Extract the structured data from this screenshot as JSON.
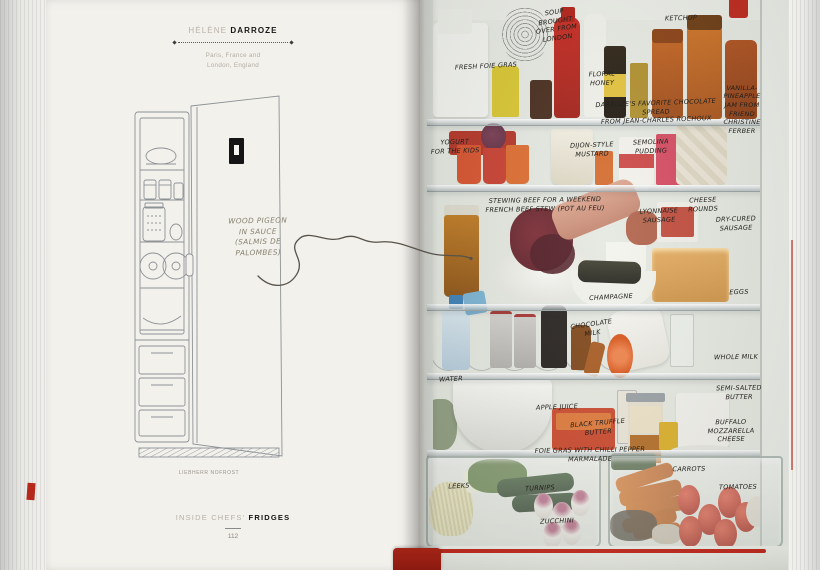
{
  "book": {
    "left_page": {
      "chef": {
        "first_name": "HÉLÈNE",
        "last_name": "DARROZE",
        "location_line1": "Paris, France and",
        "location_line2": "London, England"
      },
      "annotation": "WOOD PIGEON\nIN SAUCE\n(SALMIS DE\nPALOMBES)",
      "drawing_caption": "LIEBHERR NOFROST",
      "footer": {
        "series": "INSIDE CHEFS'",
        "title": "FRIDGES",
        "page_number": "112"
      }
    },
    "right_page": {
      "labels": [
        {
          "id": "soup",
          "text": "SOUP\nBROUGHT\nOVER FROM\nLONDON"
        },
        {
          "id": "ketchup",
          "text": "KETCHUP"
        },
        {
          "id": "fresh-foie-gras",
          "text": "FRESH FOIE GRAS"
        },
        {
          "id": "floral-honey",
          "text": "FLORAL\nHONEY"
        },
        {
          "id": "vanilla-pineapple-jam",
          "text": "VANILLA-\nPINEAPPLE\nJAM FROM\nFRIEND\nCHRISTINE\nFERBER"
        },
        {
          "id": "chocolate-spread",
          "text": "DARROZE'S FAVORITE CHOCOLATE SPREAD\nFROM JEAN-CHARLES ROCHOUX"
        },
        {
          "id": "yogurt",
          "text": "YOGURT\nFOR THE KIDS"
        },
        {
          "id": "dijon-mustard",
          "text": "DIJON-STYLE\nMUSTARD"
        },
        {
          "id": "semolina-pudding",
          "text": "SEMOLINA\nPUDDING"
        },
        {
          "id": "cheese-rounds",
          "text": "CHEESE\nROUNDS"
        },
        {
          "id": "dry-cured-sausage",
          "text": "DRY-CURED\nSAUSAGE"
        },
        {
          "id": "stewing-beef",
          "text": "STEWING BEEF FOR A WEEKEND\nFRENCH BEEF STEW (POT AU FEU)"
        },
        {
          "id": "lyonnaise-sausage",
          "text": "LYONNAISE\nSAUSAGE"
        },
        {
          "id": "champagne",
          "text": "CHAMPAGNE"
        },
        {
          "id": "eggs",
          "text": "EGGS"
        },
        {
          "id": "chocolate-milk",
          "text": "CHOCOLATE\nMILK"
        },
        {
          "id": "whole-milk",
          "text": "WHOLE MILK"
        },
        {
          "id": "water",
          "text": "WATER"
        },
        {
          "id": "semi-salted-butter",
          "text": "SEMI-SALTED\nBUTTER"
        },
        {
          "id": "apple-juice",
          "text": "APPLE JUICE"
        },
        {
          "id": "black-truffle-butter",
          "text": "BLACK TRUFFLE\nBUTTER"
        },
        {
          "id": "buffalo-mozzarella",
          "text": "BUFFALO\nMOZZARELLA\nCHEESE"
        },
        {
          "id": "foie-gras-chilli",
          "text": "FOIE GRAS WITH CHILLI PEPPER\nMARMALADE"
        },
        {
          "id": "leeks",
          "text": "LEEKS"
        },
        {
          "id": "turnips",
          "text": "TURNIPS"
        },
        {
          "id": "zucchini",
          "text": "ZUCCHINI"
        },
        {
          "id": "carrots",
          "text": "CARROTS"
        },
        {
          "id": "tomatoes",
          "text": "TOMATOES"
        }
      ]
    },
    "palette": {
      "accent_red": "#c3241c",
      "cover_red": "#9e1f14",
      "paper": "#f3f1ec",
      "pencil_gray": "#85806f",
      "ink": "#23211d"
    }
  }
}
